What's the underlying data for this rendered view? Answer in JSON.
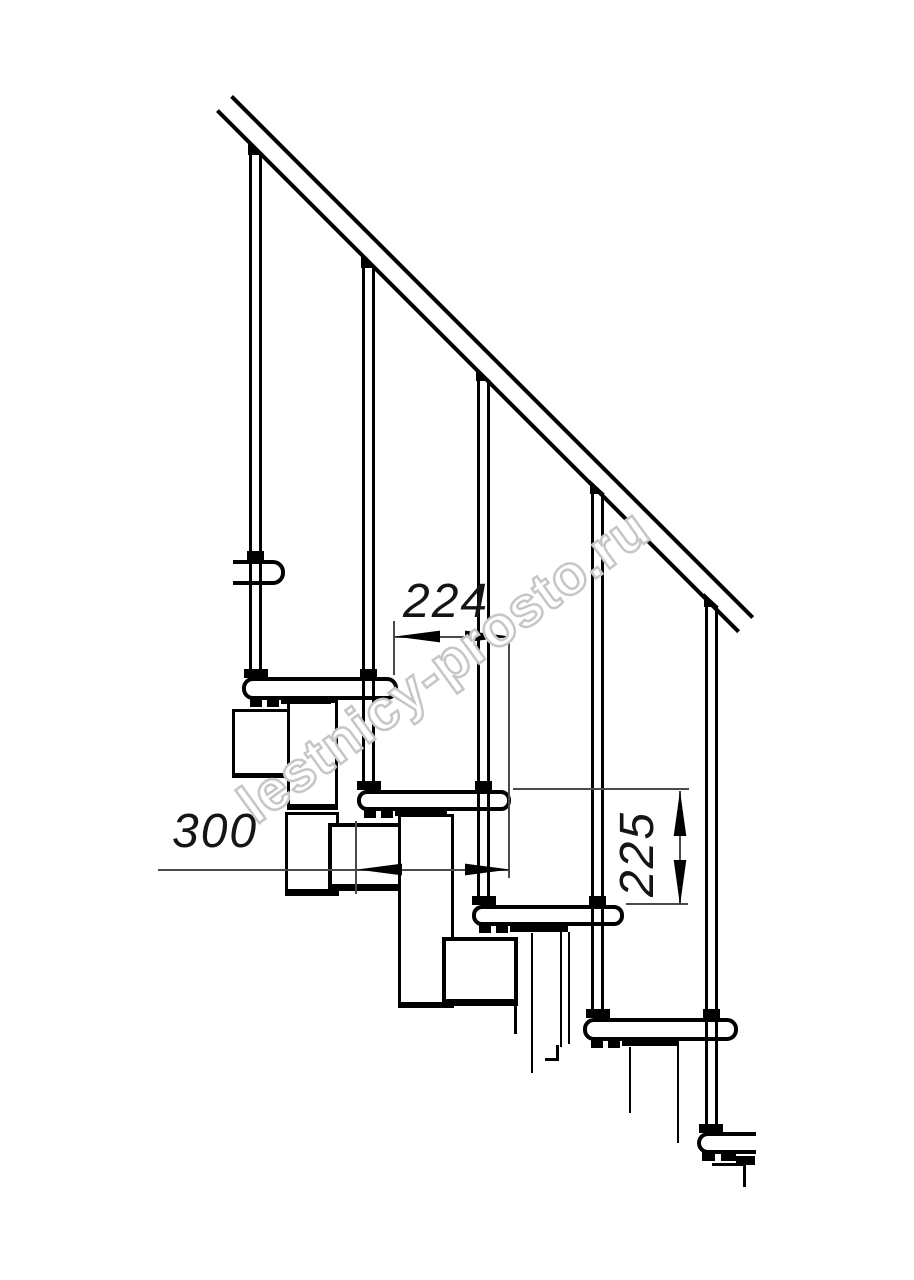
{
  "drawing": {
    "subject": "modular staircase side elevation technical drawing",
    "background": "#ffffff",
    "line_color": "#000000",
    "dim_line_color": "#4a4a4a",
    "balusters_visible": 5,
    "treads_visible": 6
  },
  "dims": {
    "run": {
      "value": "224",
      "orientation": "horizontal"
    },
    "depth": {
      "value": "300",
      "orientation": "horizontal"
    },
    "rise": {
      "value": "225",
      "orientation": "vertical"
    }
  },
  "watermark": {
    "text": "lestnicy-prosto.ru",
    "outline_color": "#c6c6c6",
    "rotation_deg": -36
  }
}
